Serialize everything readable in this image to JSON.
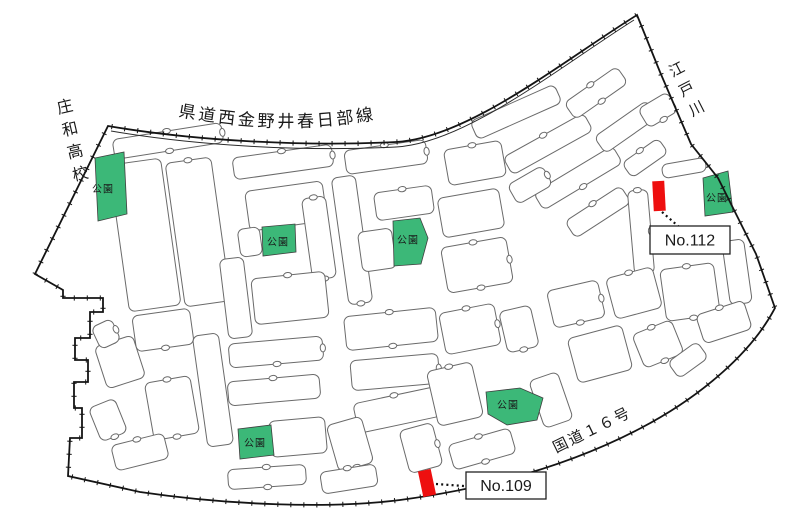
{
  "page": {
    "width": 800,
    "height": 520,
    "background": "#ffffff"
  },
  "colors": {
    "park_green": "#3cb878",
    "park_stroke": "#3f3f3f",
    "marker_red": "#ee0f0f",
    "boundary": "#141414",
    "road_line": "#2a2a2a",
    "block_stroke": "#6a6a6a",
    "block_fill": "#ffffff",
    "label_text": "#1a1a1a",
    "box_border": "#222222",
    "box_fill": "#ffffff",
    "leader": "#111111"
  },
  "labels": {
    "prefectural_road": "県道西金野井春日部線",
    "high_school": "庄和高校",
    "river": "江戸川",
    "national_route": "国道１６号",
    "park": "公園"
  },
  "site_markers": [
    {
      "label": "No.112",
      "marker": {
        "cx": 659,
        "cy": 196,
        "w": 12,
        "h": 30,
        "rot": -3
      },
      "leader": {
        "x1": 662,
        "y1": 212,
        "x2": 694,
        "y2": 240
      },
      "box": {
        "x": 650,
        "y": 226,
        "w": 80,
        "h": 28
      }
    },
    {
      "label": "No.109",
      "marker": {
        "cx": 427,
        "cy": 483,
        "w": 13,
        "h": 26,
        "rot": -12
      },
      "leader": {
        "x1": 436,
        "y1": 484,
        "x2": 464,
        "y2": 486
      },
      "box": {
        "x": 466,
        "y": 472,
        "w": 80,
        "h": 27
      }
    }
  ],
  "parks": [
    {
      "points": "95,158 124,152 127,214 98,221",
      "lx": 103,
      "ly": 190
    },
    {
      "points": "262,227 295,224 296,252 263,256",
      "lx": 278,
      "ly": 243
    },
    {
      "points": "393,221 420,218 428,238 421,264 394,266",
      "lx": 408,
      "ly": 241
    },
    {
      "points": "703,178 728,171 733,212 705,216",
      "lx": 717,
      "ly": 199
    },
    {
      "points": "486,392 520,388 543,398 537,420 507,425 488,414",
      "lx": 508,
      "ly": 406
    },
    {
      "points": "238,429 271,425 274,455 240,459",
      "lx": 255,
      "ly": 444
    }
  ],
  "boundary": {
    "outer_path": "M108,126 C190,140 300,147 396,142 C468,138 560,63 637,15 L660,72 L691,144 L718,178 L756,254 L775,308 C752,352 702,396 641,428 C578,461 498,487 400,500 C330,509 228,505 140,492 L68,476 L70,438 L82,438 L82,408 L74,408 L74,382 L88,382 L88,360 L75,360 L75,338 L90,338 L90,312 L103,312 L103,298 L63,298 L63,290 L35,274 Z",
    "road_inner_path": "M111,131 C192,145 300,152 396,147 C466,143 558,68 634,20",
    "road_label_path": "M178,116 C262,132 332,131 410,112",
    "tick_spacing": 13,
    "tick_half_len": 2.6
  },
  "text_annotations": {
    "school": {
      "x": 66,
      "y": 112,
      "rot": -13,
      "dy": 23,
      "size": 16
    },
    "river": {
      "x": 679,
      "y": 74,
      "rot": -27,
      "dy": 22,
      "size": 15
    },
    "route": {
      "x": 556,
      "y": 453,
      "rot": -26,
      "size": 15,
      "spacing": 2
    },
    "road": {
      "size": 17,
      "spacing": 3
    },
    "park_label_size": 10,
    "marker_label_size": 16
  },
  "blocks": [
    [
      168,
      141,
      110,
      20,
      -9
    ],
    [
      145,
      235,
      52,
      148,
      -8
    ],
    [
      198,
      232,
      46,
      145,
      -8
    ],
    [
      163,
      330,
      58,
      36,
      -8
    ],
    [
      120,
      362,
      40,
      44,
      -18
    ],
    [
      106,
      334,
      22,
      24,
      -25
    ],
    [
      172,
      408,
      46,
      58,
      -10
    ],
    [
      213,
      390,
      26,
      112,
      -8
    ],
    [
      140,
      452,
      54,
      26,
      -14
    ],
    [
      108,
      420,
      28,
      36,
      -22
    ],
    [
      283,
      162,
      100,
      22,
      -8
    ],
    [
      286,
      206,
      78,
      40,
      -8
    ],
    [
      319,
      238,
      24,
      82,
      -8
    ],
    [
      250,
      242,
      22,
      28,
      -8
    ],
    [
      290,
      298,
      74,
      46,
      -6
    ],
    [
      276,
      352,
      94,
      24,
      -5
    ],
    [
      274,
      390,
      92,
      24,
      -5
    ],
    [
      298,
      437,
      56,
      36,
      -5
    ],
    [
      267,
      477,
      78,
      20,
      -4
    ],
    [
      236,
      298,
      24,
      80,
      -7
    ],
    [
      386,
      157,
      82,
      24,
      -8
    ],
    [
      352,
      240,
      24,
      128,
      -8
    ],
    [
      404,
      203,
      58,
      28,
      -8
    ],
    [
      377,
      250,
      34,
      40,
      -8
    ],
    [
      391,
      329,
      92,
      34,
      -6
    ],
    [
      395,
      372,
      88,
      30,
      -5
    ],
    [
      397,
      410,
      84,
      30,
      -12
    ],
    [
      350,
      444,
      36,
      48,
      -16
    ],
    [
      475,
      163,
      58,
      36,
      -10
    ],
    [
      471,
      213,
      62,
      40,
      -10
    ],
    [
      477,
      265,
      66,
      46,
      -10
    ],
    [
      516,
      112,
      92,
      20,
      -24
    ],
    [
      548,
      144,
      92,
      20,
      -29
    ],
    [
      578,
      178,
      92,
      20,
      -31
    ],
    [
      598,
      212,
      66,
      20,
      -33
    ],
    [
      530,
      185,
      40,
      22,
      -30
    ],
    [
      596,
      93,
      64,
      20,
      -35
    ],
    [
      626,
      127,
      64,
      20,
      -35
    ],
    [
      645,
      158,
      44,
      18,
      -35
    ],
    [
      658,
      110,
      34,
      22,
      -31
    ],
    [
      641,
      232,
      20,
      84,
      -5
    ],
    [
      684,
      168,
      44,
      14,
      -10
    ],
    [
      690,
      292,
      54,
      52,
      -8
    ],
    [
      737,
      272,
      22,
      64,
      -8
    ],
    [
      724,
      322,
      50,
      30,
      -18
    ],
    [
      576,
      304,
      52,
      38,
      -13
    ],
    [
      634,
      293,
      48,
      42,
      -15
    ],
    [
      600,
      354,
      56,
      46,
      -15
    ],
    [
      658,
      344,
      42,
      36,
      -22
    ],
    [
      688,
      360,
      36,
      20,
      -36
    ],
    [
      470,
      329,
      56,
      42,
      -11
    ],
    [
      519,
      329,
      32,
      42,
      -13
    ],
    [
      455,
      394,
      46,
      56,
      -13
    ],
    [
      551,
      400,
      30,
      50,
      -19
    ],
    [
      482,
      449,
      64,
      26,
      -16
    ],
    [
      421,
      448,
      34,
      44,
      -15
    ],
    [
      349,
      479,
      56,
      22,
      -9
    ]
  ]
}
